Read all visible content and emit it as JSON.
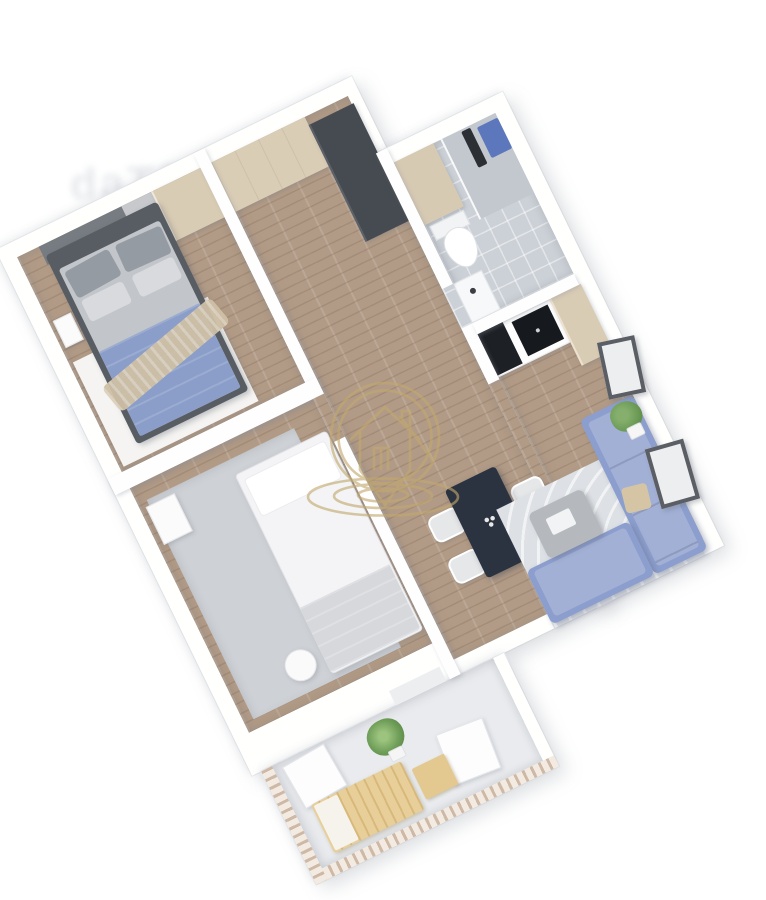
{
  "image": {
    "kind": "3d-floor-plan-render",
    "description": "Top-down 3D rendering of a two-bedroom apartment with balcony, rotated diagonally on a white background",
    "background_color": "#ffffff"
  },
  "watermark": {
    "logo_color": "#c2a96e",
    "elements": [
      "double-circle",
      "house-outline-with-chimney",
      "door",
      "location-pin-point",
      "ripple-ellipses"
    ],
    "faint_text_fragment": "daTS"
  },
  "palette": {
    "wall": "#ffffff",
    "wood_floor": "#b29b86",
    "bathroom_tile": "#ccd1d7",
    "gray_rug": "#ced1d5",
    "living_rug": "#dde0e4",
    "sofa_blue": "#8c9ecd",
    "blanket_blue": "#8b9ec9",
    "cabinet_tan": "#d9ccb5",
    "dark_wardrobe": "#464b51",
    "dining_table_navy": "#2b3240",
    "cooktop_black": "#16191e",
    "balcony_wood": "#e8cf99",
    "plant_green": "#6f9e59",
    "towel_blue": "#5d77bc"
  },
  "rooms": [
    {
      "name": "bedroom-1",
      "floor": "wood",
      "furniture": [
        "double-bed",
        "gray-pillows",
        "blue-blanket",
        "beige-throw",
        "wardrobe",
        "nightstand",
        "white-rug"
      ]
    },
    {
      "name": "hallway",
      "floor": "wood",
      "furniture": [
        "tan-cabinet",
        "dark-wardrobe"
      ]
    },
    {
      "name": "bathroom",
      "floor": "tile",
      "furniture": [
        "toilet",
        "sink",
        "shower",
        "glass-screen",
        "blue-towel",
        "tan-partition"
      ]
    },
    {
      "name": "kitchen-living-area",
      "floor": "wood",
      "furniture": [
        "kitchen-counter",
        "cooktop",
        "dark-base-cabinet",
        "tall-tan-cabinet",
        "dining-table",
        "chairs-x4",
        "corner-sofa",
        "beige-pillow",
        "coffee-table",
        "striped-rug",
        "picture-frames-x2",
        "potted-plant"
      ]
    },
    {
      "name": "bedroom-2",
      "floor": "wood-with-gray-rug",
      "furniture": [
        "single-bed",
        "pillow",
        "gray-blanket",
        "pouf",
        "dresser"
      ]
    },
    {
      "name": "balcony",
      "floor": "light-gray",
      "furniture": [
        "wooden-lounger",
        "seat-cushion",
        "side-table",
        "white-chairs-x2",
        "potted-plant",
        "striped-railing"
      ]
    }
  ]
}
